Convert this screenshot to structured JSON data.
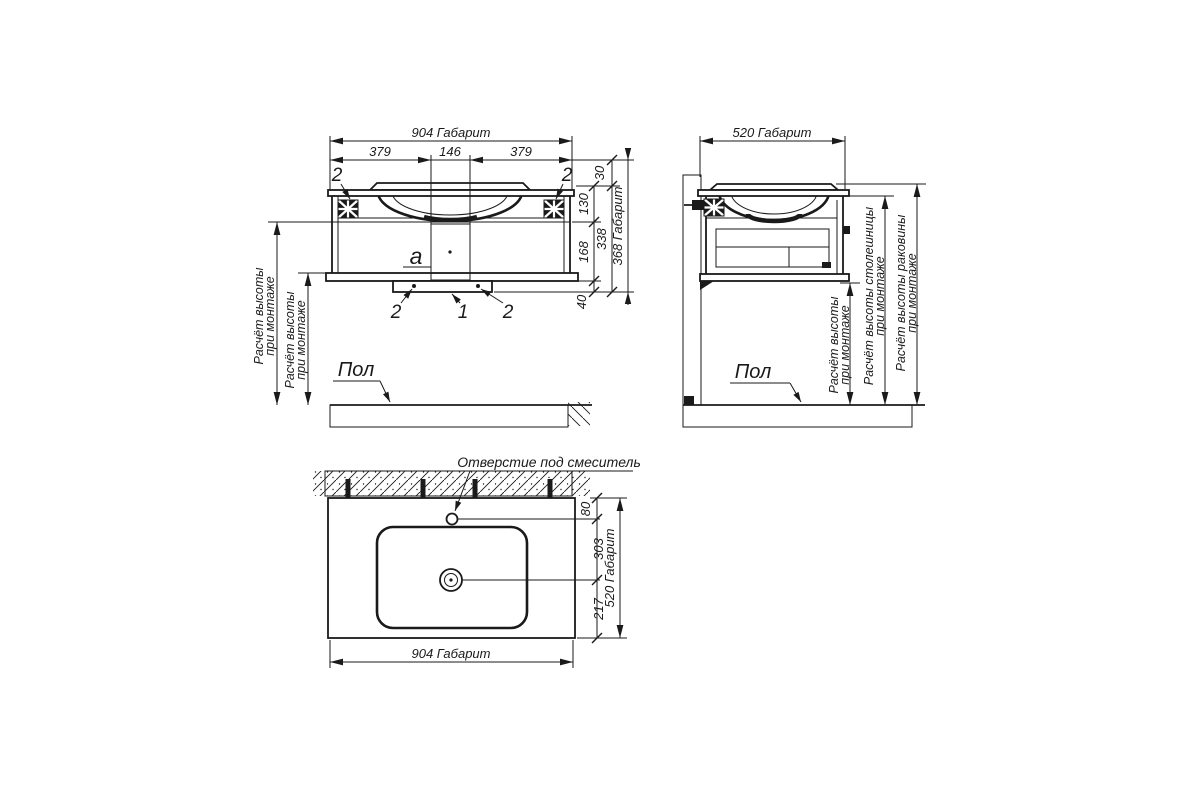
{
  "drawing": {
    "front_view": {
      "dim_width_overall": "904 Габарит",
      "dim_left_span": "379",
      "dim_center_span": "146",
      "dim_right_span": "379",
      "dim_rim": "30",
      "dim_basin_depth": "130",
      "dim_lower_body": "168",
      "dim_plinth": "40",
      "dim_body_total": "338",
      "dim_height_overall": "368 Габарит",
      "callout_bracket_left": "2",
      "callout_bracket_right": "2",
      "callout_channel": "a",
      "callout_foot_left": "2",
      "callout_drain": "1",
      "callout_foot_right": "2",
      "mount_note_outer_line1": "Расчёт высоты",
      "mount_note_outer_line2": "при монтаже",
      "mount_note_inner_line1": "Расчёт высоты",
      "mount_note_inner_line2": "при монтаже",
      "floor_label": "Пол"
    },
    "side_view": {
      "dim_depth_overall": "520 Габарит",
      "mount_note_line1": "Расчёт высоты",
      "mount_note_line2": "при монтаже",
      "counter_note_line1": "Расчёт высоты столешницы",
      "counter_note_line2": "при монтаже",
      "basin_note_line1": "Расчёт высоты раковины",
      "basin_note_line2": "при монтаже",
      "floor_label": "Пол"
    },
    "top_view": {
      "faucet_label": "Отверстие под смеситель",
      "dim_faucet_offset": "80",
      "dim_faucet_to_drain": "303",
      "dim_drain_to_front": "217",
      "dim_depth_overall": "520 Габарит",
      "dim_width_overall": "904 Габарит"
    },
    "colors": {
      "line": "#1a1a1a",
      "background": "#ffffff"
    }
  }
}
